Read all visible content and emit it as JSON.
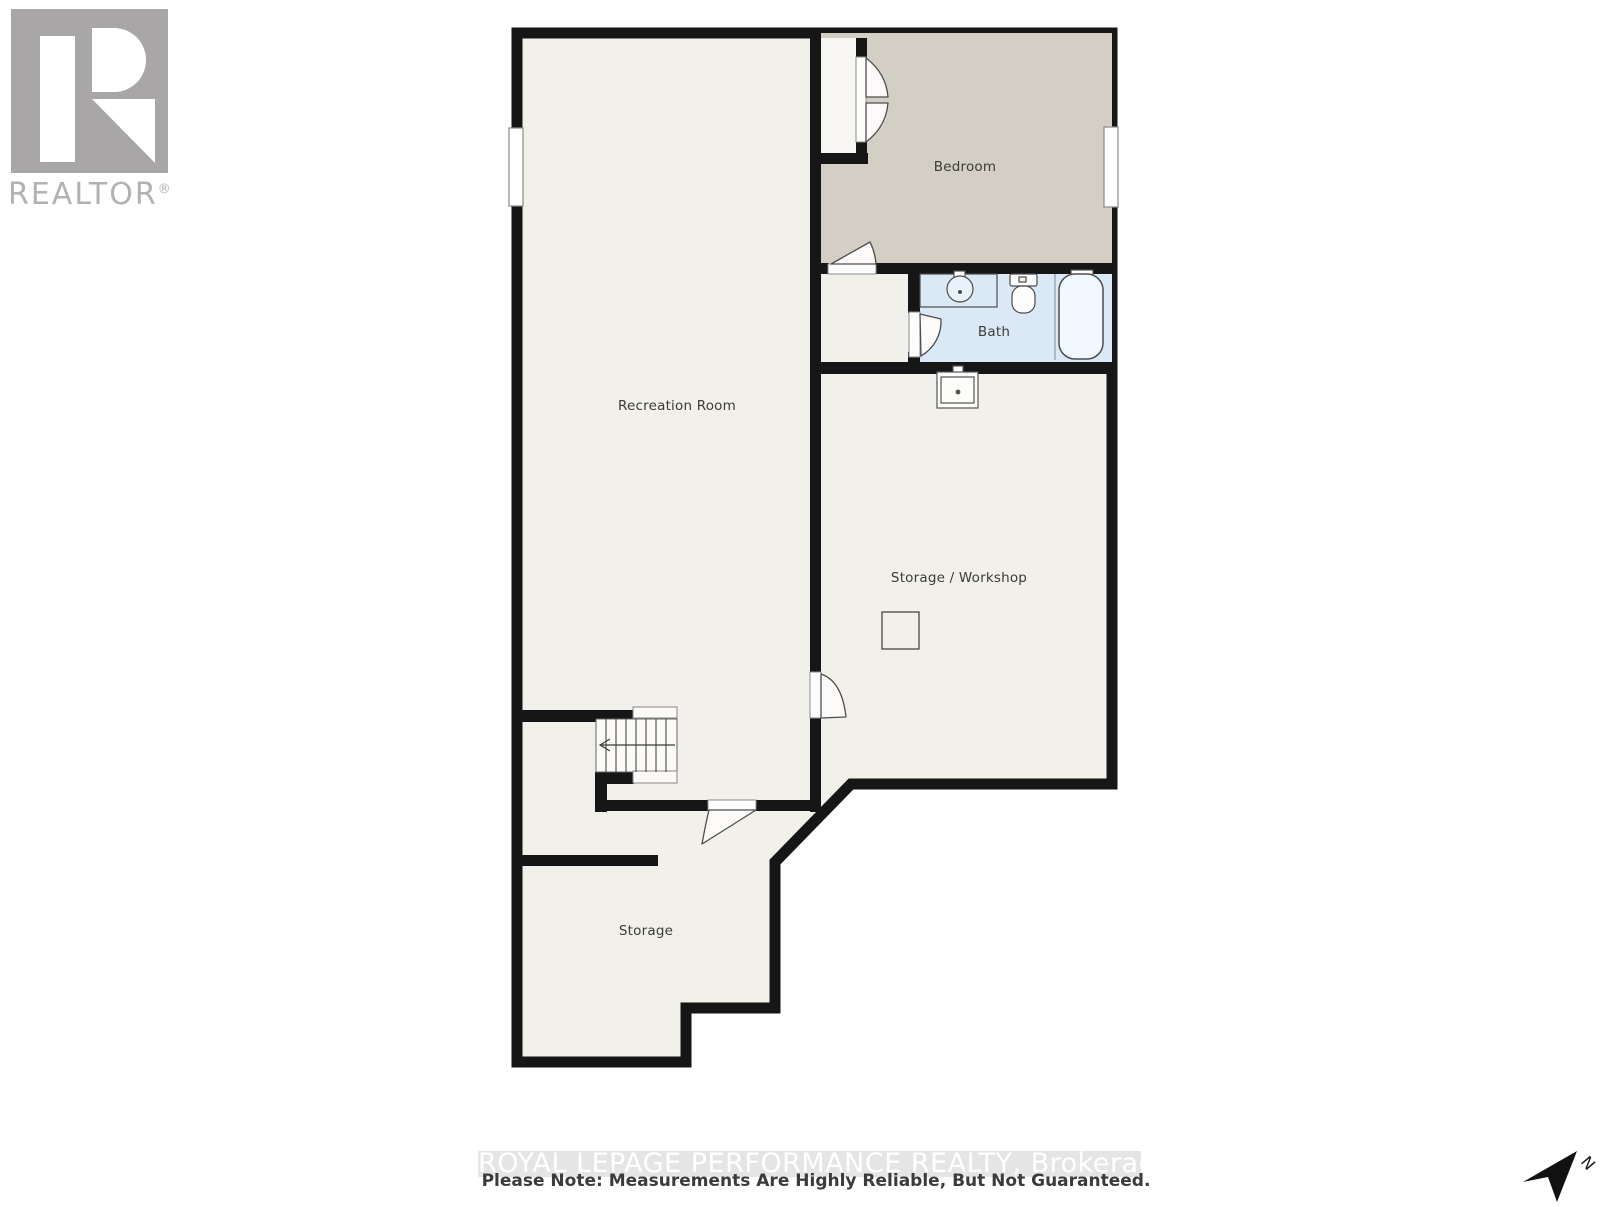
{
  "branding": {
    "name": "REALTOR",
    "registered_mark": "®"
  },
  "rooms": {
    "recreation": {
      "label": "Recreation Room"
    },
    "bedroom": {
      "label": "Bedroom"
    },
    "bath": {
      "label": "Bath"
    },
    "storage_workshop": {
      "label": "Storage / Workshop"
    },
    "storage": {
      "label": "Storage"
    }
  },
  "footer": {
    "watermark": "ROYAL LEPAGE PERFORMANCE REALTY, Brokerage",
    "note": "Please Note: Measurements Are Highly Reliable, But Not Guaranteed."
  },
  "compass": {
    "north": "N"
  },
  "colors": {
    "wall": "#161616",
    "floor": "#f2f0ea",
    "bedroom_floor": "#d3cfc5",
    "closet_floor": "#f7f6f2",
    "bath_floor": "#dbe9f6",
    "fixture_outline": "#4d4d4d",
    "watermark_band": "#e5e5e5",
    "logo_gray": "#a8a6a6",
    "label_text": "#3b3b3b"
  }
}
